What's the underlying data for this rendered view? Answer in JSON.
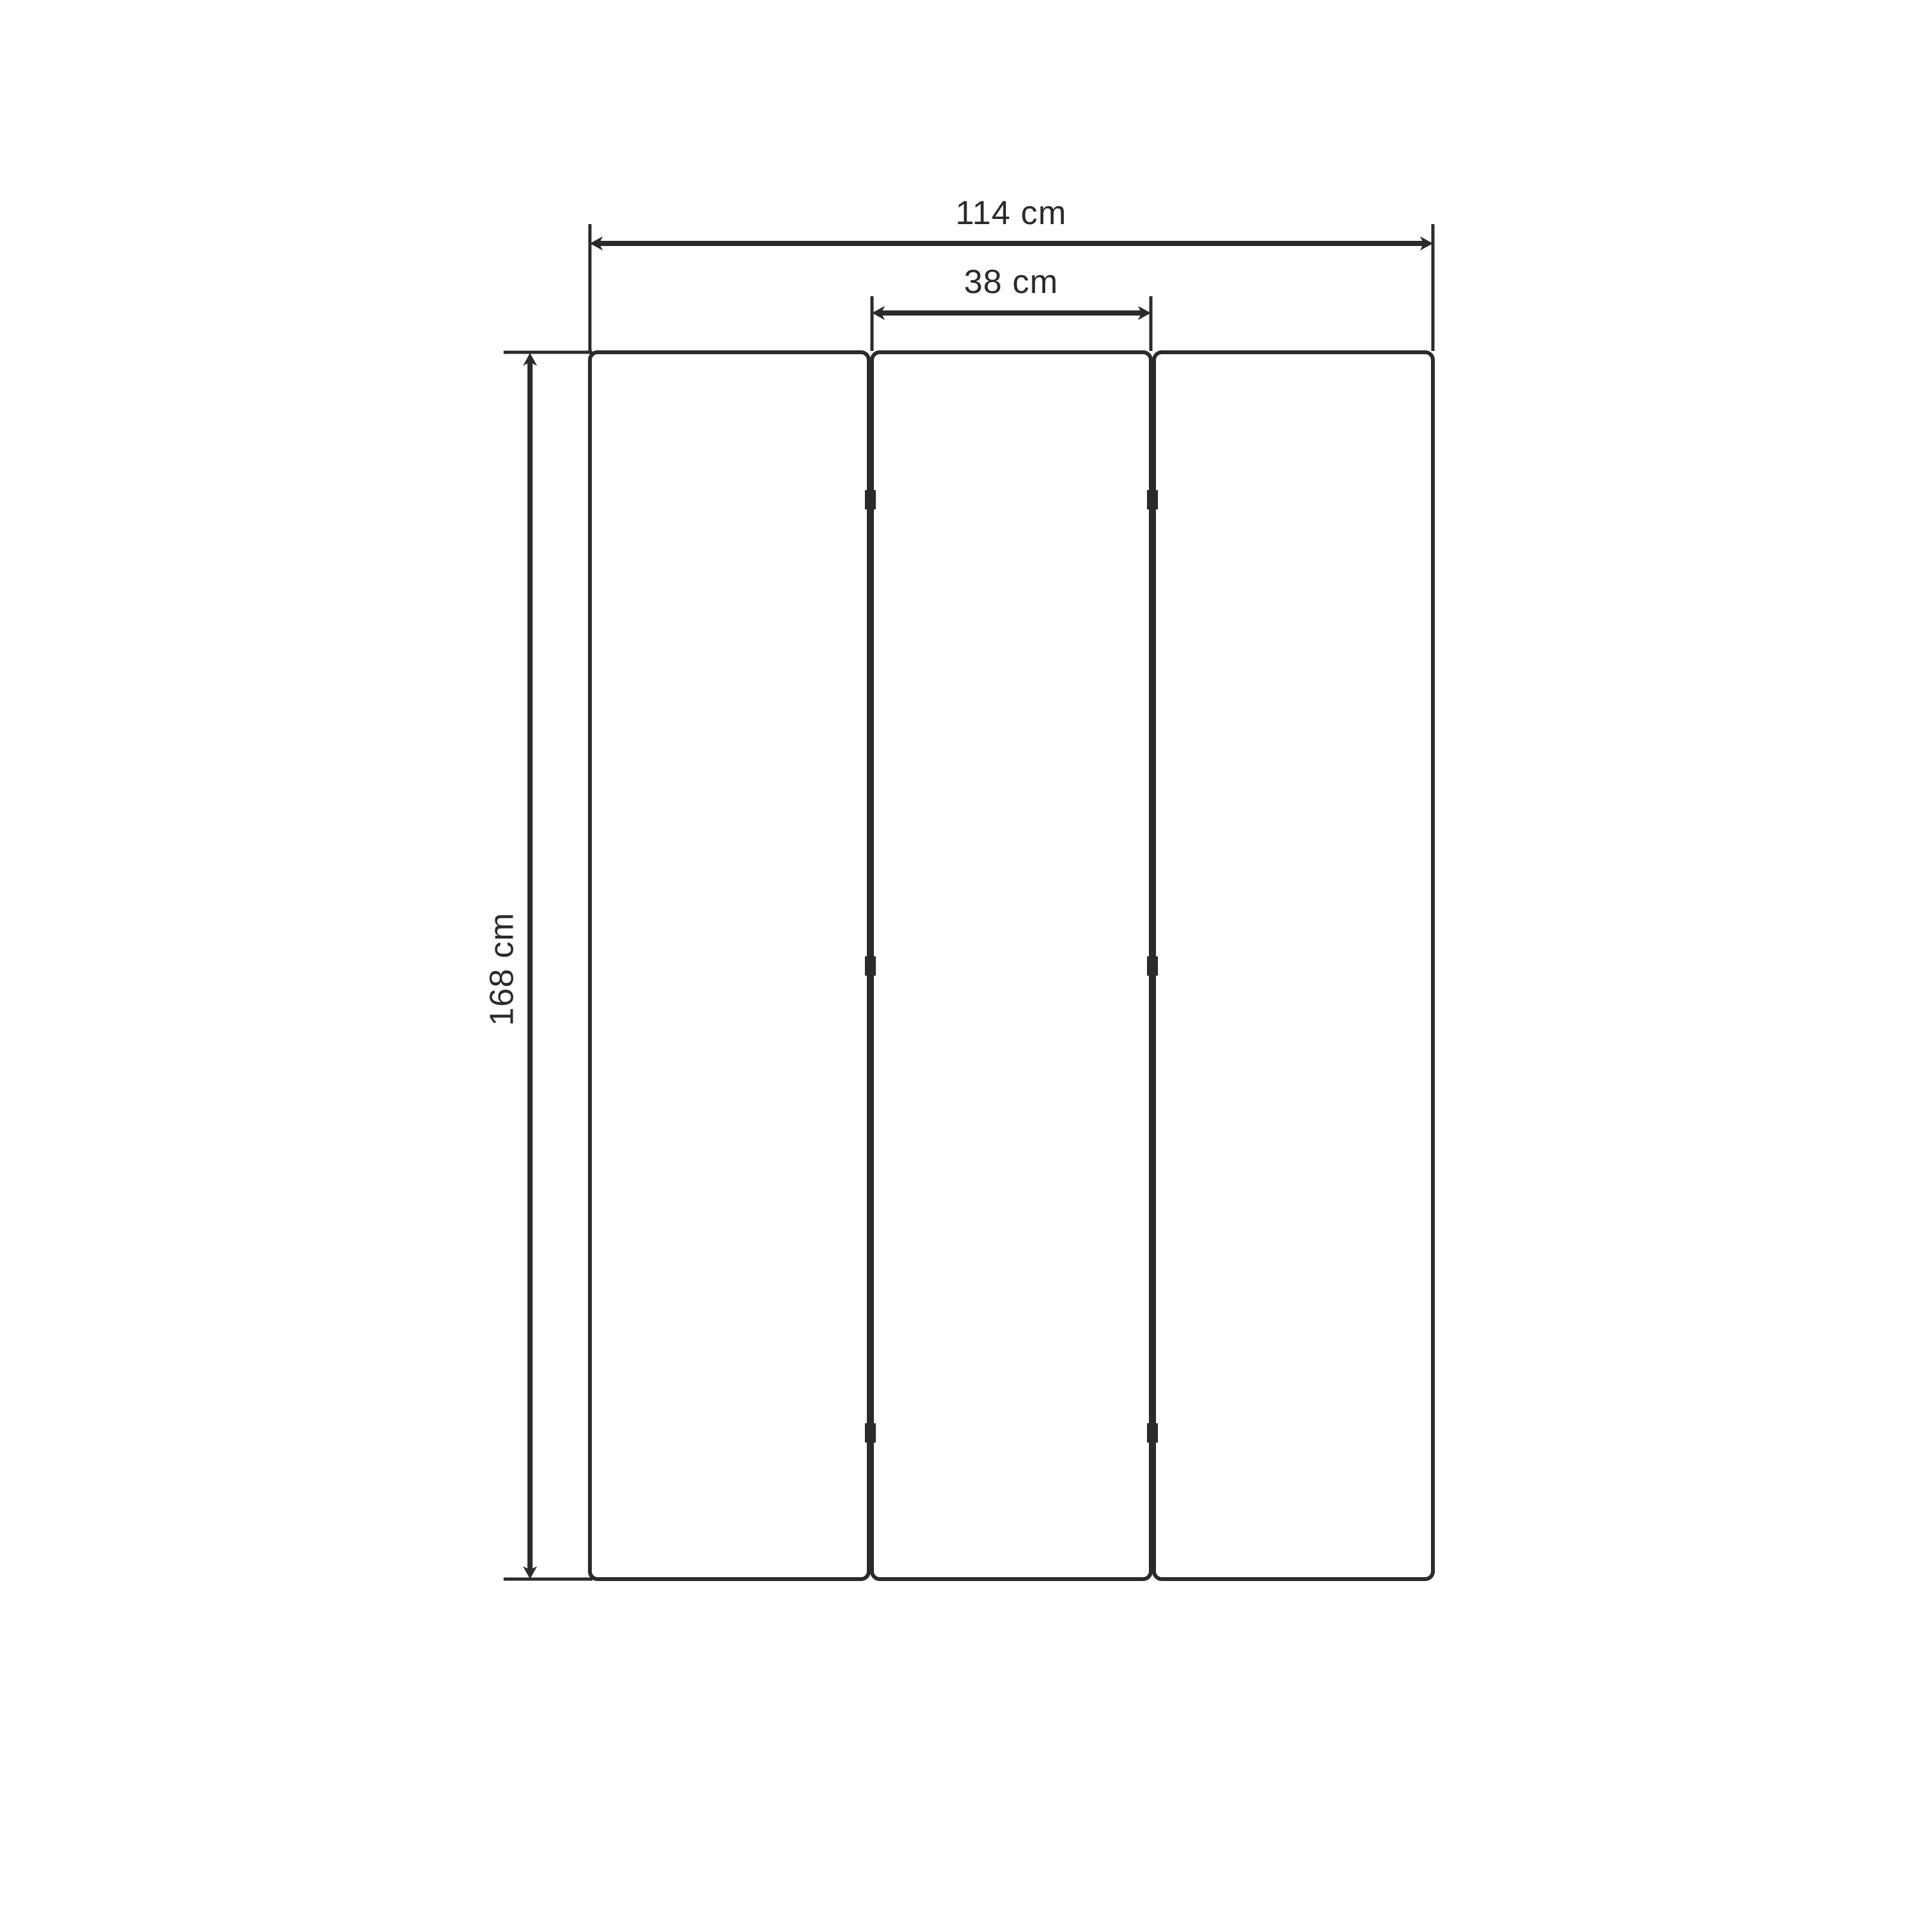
{
  "colors": {
    "line": "#2b2b2b",
    "background": "#ffffff"
  },
  "diagram": {
    "panels": {
      "count": 3,
      "hinge_marks_per_gap": 3
    },
    "dimensions": {
      "total_width_label": "114 cm",
      "panel_width_label": "38 cm",
      "height_label": "168 cm"
    }
  }
}
